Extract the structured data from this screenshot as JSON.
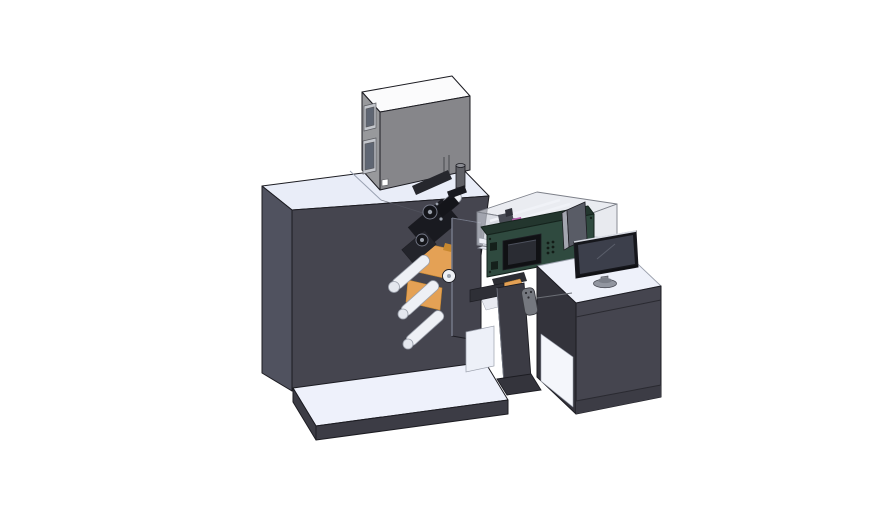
{
  "scene": {
    "kind": "3d-cad-render",
    "subject": "label printing machine line with feeder box, web rollers, control unit, enclosure and operator desk with monitor",
    "background": "#ffffff"
  },
  "parts": [
    {
      "name": "feeder-box",
      "desc": "gray box unit on top of machine"
    },
    {
      "name": "machine-body",
      "desc": "large dark machine tower"
    },
    {
      "name": "machine-base",
      "desc": "flat base platform"
    },
    {
      "name": "web-mechanism",
      "desc": "rollers, orange web material, print head"
    },
    {
      "name": "glass-enclosure",
      "desc": "translucent cover with internal parts"
    },
    {
      "name": "control-unit",
      "desc": "dark green box with display and buttons"
    },
    {
      "name": "pedestal",
      "desc": "stand between machine and desk"
    },
    {
      "name": "desk",
      "desc": "operator cabinet with white top"
    },
    {
      "name": "monitor",
      "desc": "desktop display on oval base"
    }
  ],
  "colors": {
    "background": "#ffffff",
    "outline": "#1c1c22",
    "machine_top": "#e9edf8",
    "machine_left": "#50525f",
    "machine_front": "#45454f",
    "machine_seam": "#9aa2b2",
    "machine_crease": "#565863",
    "base_top": "#eef1fb",
    "base_skirt": "#3c3c45",
    "box_top": "#fbfbfc",
    "box_left": "#98999c",
    "box_front": "#86868a",
    "box_window_frame": "#c3c6cc",
    "box_window_pane": "#5f6673",
    "box_slot": "#5a5b60",
    "box_label": "#ffffff",
    "knob_body": "#5f6066",
    "knob_top": "#8a8b92",
    "mech_dark_top": "#26272d",
    "roller_fill": "#eef0f5",
    "roller_stroke": "#9ba0ab",
    "roller_cap": "#e4e7ee",
    "web_orange": "#e4a155",
    "web_orange_dark": "#c8882f",
    "mech_black": "#191a20",
    "mech_black_2": "#23242b",
    "mech_black_3": "#14151a",
    "mech_dot": "#9aa0ab",
    "panel_face": "#43434d",
    "panel_highlight": "#757988",
    "stand_surface": "#e7eaf3",
    "glass_rim": "#dfe2ea",
    "glass_wall": "#c9cdd7",
    "glass_wall_right": "#d5d8e1",
    "glass_stroke": "#7d8089",
    "glass_slat": "#f0f2f7",
    "glass_rail": "#eef0f7",
    "magenta_part": "#b85fae",
    "inner_part": "#4a4d56",
    "inner_part_dark": "#30323a",
    "ramp_dark": "#2c2d33",
    "ramp_white": "#e8eaf1",
    "green_face": "#2f4a3f",
    "green_top": "#23362e",
    "green_edge": "#15231d",
    "screen_bezel": "#101114",
    "screen_face": "#2a2c33",
    "screen_glint": "#4c505c",
    "button_dot": "#131c17",
    "green_inset": "#15201b",
    "beam": "#2e2f36",
    "pedestal": "#3b3b44",
    "pedestal_edge": "#6a6e7a",
    "pedestal_foot": "#34343c",
    "shelf_white": "#edf0f8",
    "fob_body": "#75787f",
    "fob_stroke": "#3a3b41",
    "fob_dot": "#2b2c31",
    "cable": "#6b6e75",
    "desk_top": "#eef1fa",
    "desk_top_stroke": "#9ba0ac",
    "desk_front": "#45454f",
    "desk_left": "#33333b",
    "desk_kick": "#3c3c45",
    "desk_seam": "#2a2a31",
    "desk_interior": "#f4f6fb",
    "side_panel": "#595c66",
    "side_panel_light": "#a3a6b0",
    "monitor_bezel": "#16171c",
    "monitor_screen": "#3c3f4b",
    "monitor_highlight": "#d8dbe3",
    "monitor_reflection": "#5a5e6a",
    "monitor_stand": "#84878f",
    "monitor_base": "#9296a0",
    "monitor_base_top": "#7b7f89",
    "monitor_base_stroke": "#4a4c55"
  }
}
